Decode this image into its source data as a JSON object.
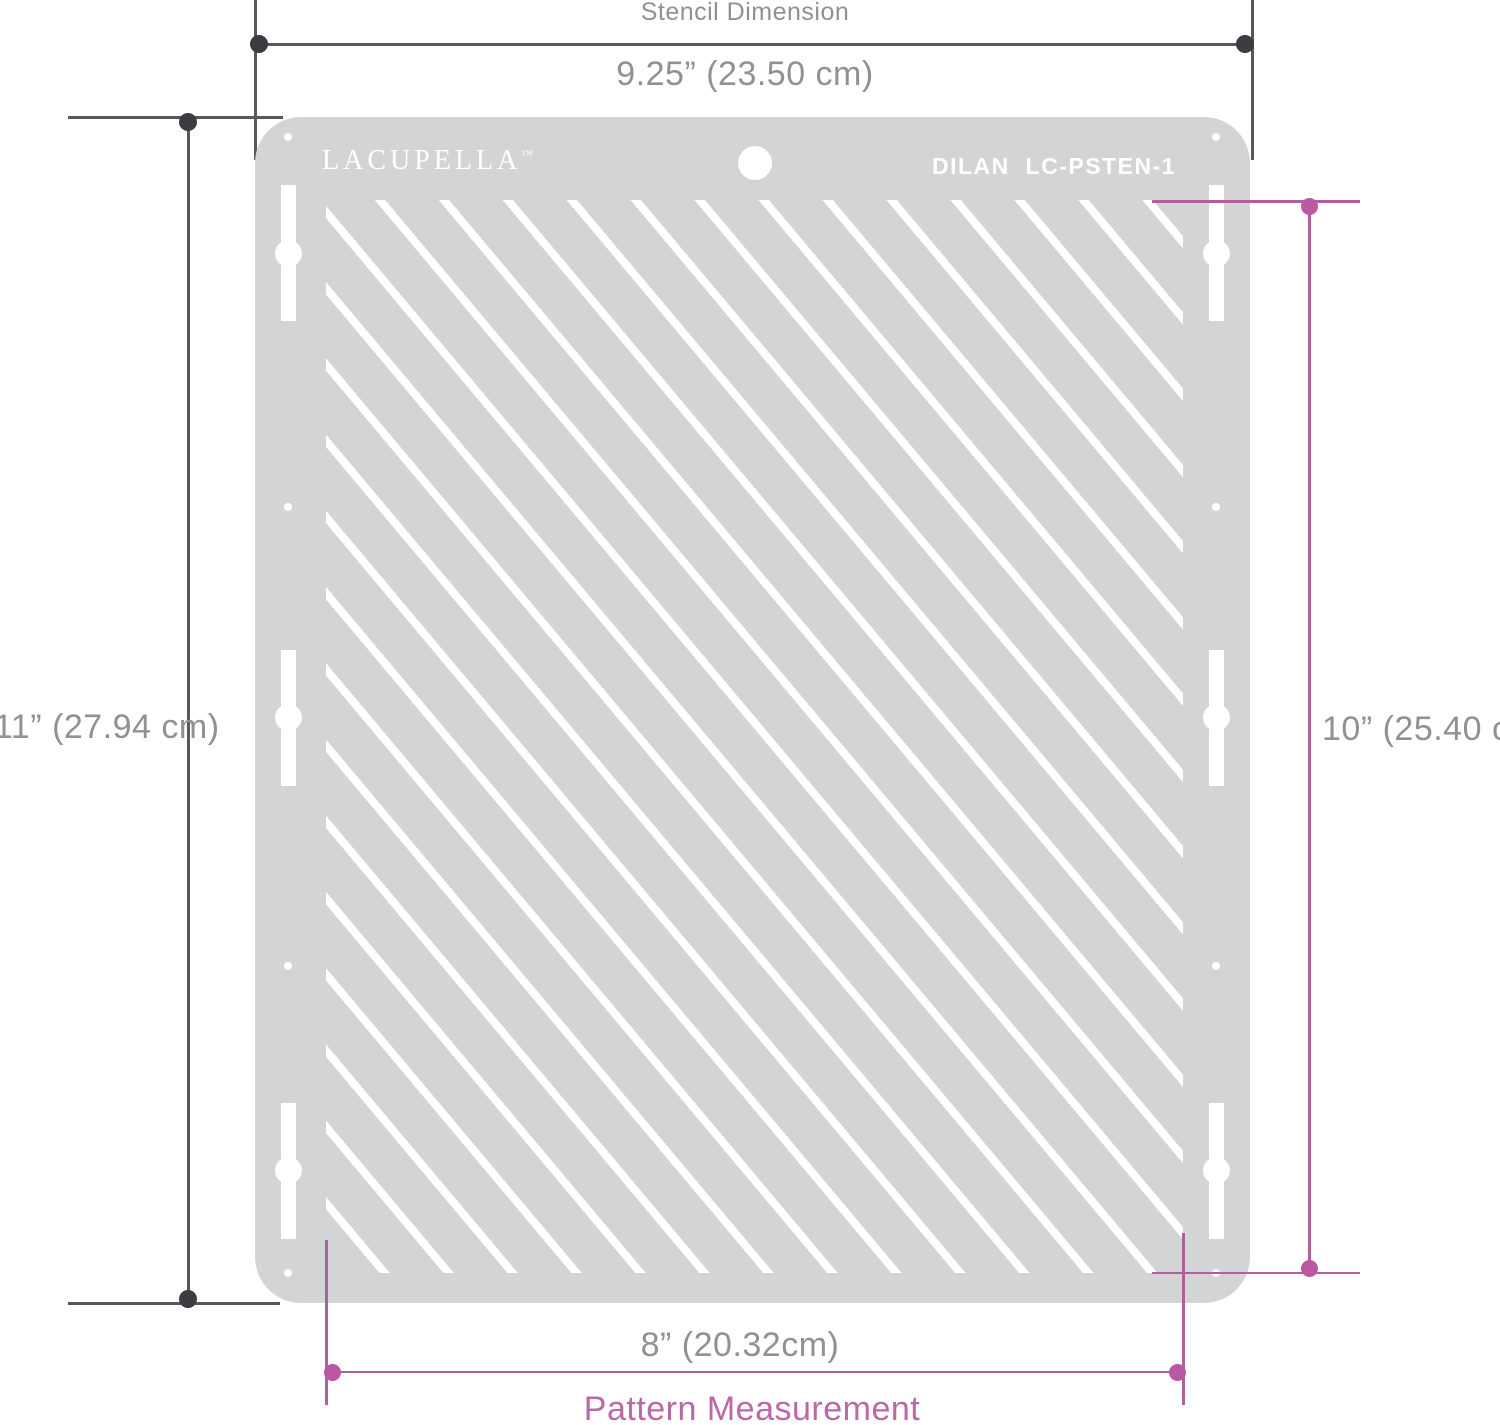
{
  "stencil": {
    "brand": "LACUPELLA",
    "brand_tm": "™",
    "model": "DILAN  LC-PSTEN-1"
  },
  "dimensions": {
    "top": {
      "title": "Stencil Dimension",
      "value": "9.25” (23.50 cm)"
    },
    "left": {
      "value": "11” (27.94 cm)"
    },
    "right": {
      "value": "10” (25.40 cm)"
    },
    "bottom": {
      "value": "8” (20.32cm)",
      "title": "Pattern Measurement"
    }
  },
  "colors": {
    "sheet_gray": "#d2d4d6",
    "line_dark": "#56585c",
    "dot_dark": "#3a3c40",
    "text_gray": "#8f9193",
    "accent_pink_line": "#b0619d",
    "accent_pink_dot": "#bc58a3",
    "accent_pink_text": "#bb68a6",
    "cutout_white": "#ffffff"
  }
}
